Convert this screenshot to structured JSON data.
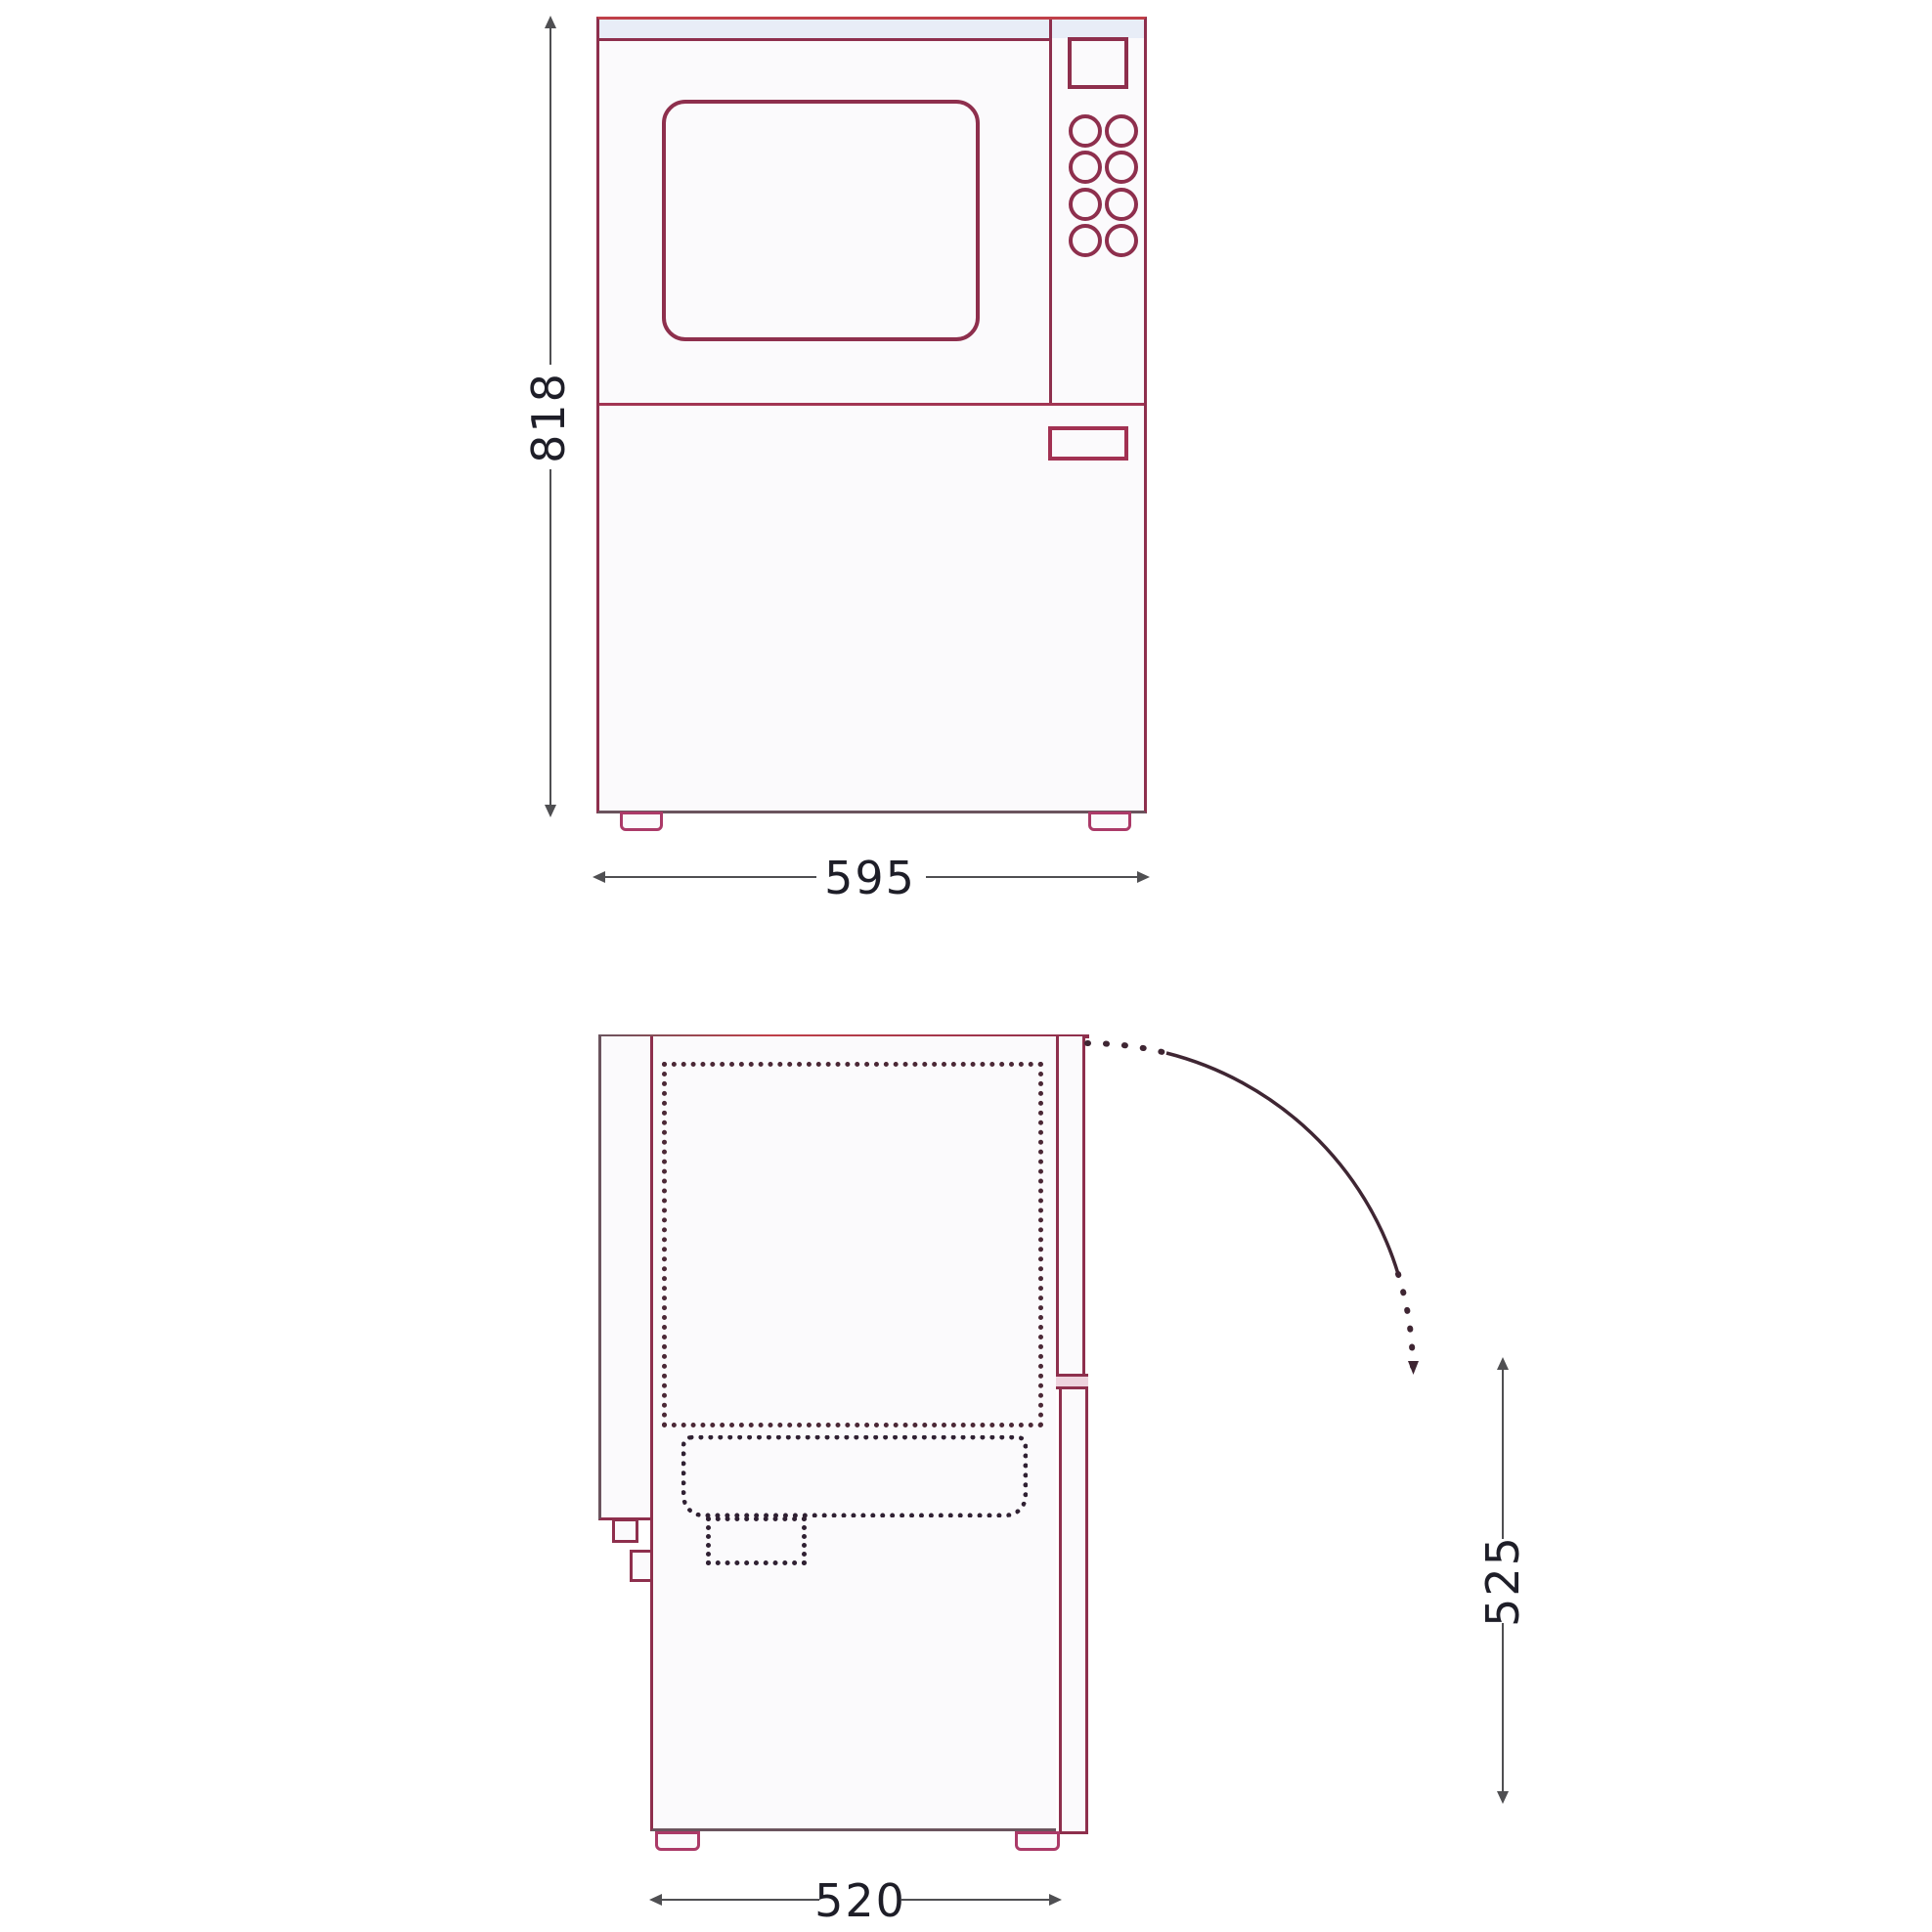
{
  "diagram": {
    "title": "appliance-dimension-drawing",
    "views": [
      {
        "id": "front-view",
        "description": "front elevation of built-in microwave combination unit"
      },
      {
        "id": "side-view",
        "description": "side section with door swing arc and dashed cavity outlines"
      }
    ]
  },
  "dims": {
    "front_height": "818",
    "front_width": "595",
    "side_depth": "520",
    "side_height": "525"
  },
  "colors": {
    "outline": "#8e2f4d",
    "outline_bright": "#c04049",
    "outline_dark": "#6b545e",
    "accent_pink": "#ab3a68",
    "handle": "#a23152",
    "divider": "#a23553",
    "dim_line": "#4f4f52",
    "dim_text": "#1e1e28",
    "dotted": "#4b2836",
    "dotted_dark": "#302133",
    "arc": "#3f2633",
    "fill": "#fbfafc",
    "strip_fill": "#e8edf7",
    "door_band_fill": "#eed3de"
  }
}
